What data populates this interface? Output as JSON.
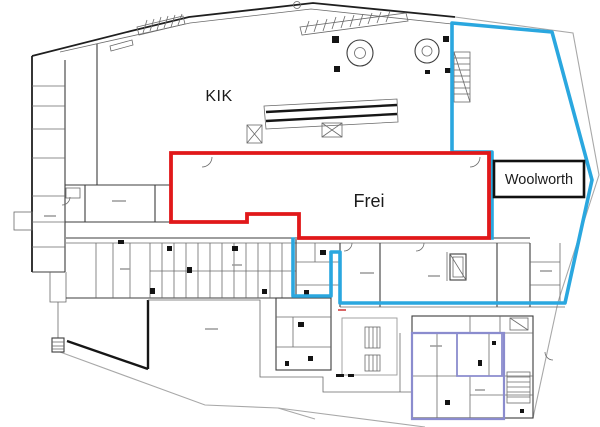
{
  "image_type": "architectural floor plan with leased-area overlays",
  "labels": {
    "kik": {
      "text": "KIK",
      "x": 219,
      "y": 101
    },
    "frei": {
      "text": "Frei",
      "x": 369,
      "y": 207
    },
    "woolworth": {
      "text": "Woolworth",
      "box": {
        "x": 494,
        "y": 161,
        "w": 90,
        "h": 36
      },
      "text_x": 539,
      "text_y": 184
    }
  },
  "colors": {
    "frei_outline": "#e1181a",
    "woolworth_outline": "#2aa7df",
    "annex_outline": "#8b8cce",
    "label_box_border": "#111111"
  },
  "overlays": {
    "frei_region": {
      "points": "171,153 489,153 489,238 299,238 299,214 247,214 247,222 171,222"
    },
    "woolworth_boundary": {
      "points": "293,239 293,296 331,296 331,252 340,252 340,303 565,303 592,180 552,32 452,23 452,152 492,152 492,238"
    },
    "annex_outer": {
      "points": "412,333 504,333 504,419 412,419"
    },
    "annex_inner": {
      "points": "457,333 502,333 502,376 457,376"
    }
  }
}
